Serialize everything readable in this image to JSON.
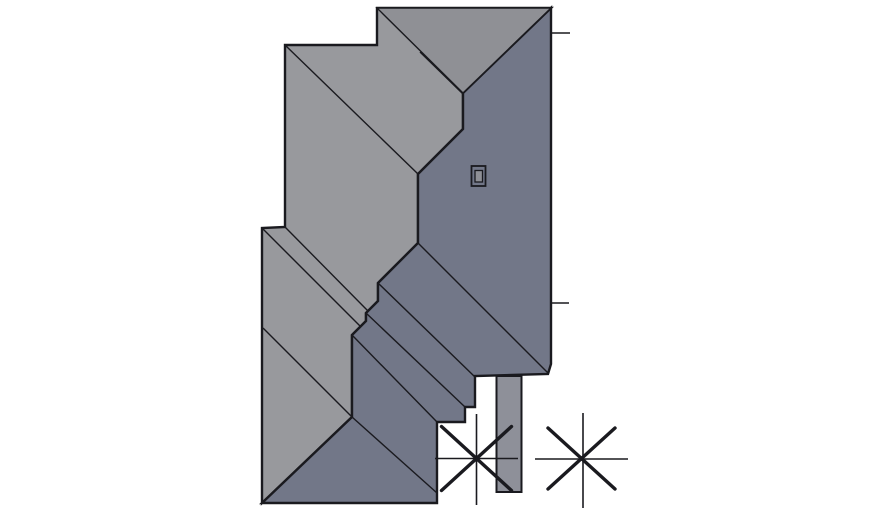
{
  "canvas": {
    "width": 870,
    "height": 515,
    "background": "#ffffff"
  },
  "colors": {
    "light_roof": "#98999d",
    "top_hip_face": "#8f9095",
    "dark_roof": "#727788",
    "strip_fill": "#8e9099",
    "vent_inner_fill": "#8f9096",
    "line": "#1a1a1f"
  },
  "roof_plan": {
    "light_region": {
      "points": [
        [
          377,
          8
        ],
        [
          551,
          8
        ],
        [
          463,
          93
        ],
        [
          463,
          129
        ],
        [
          418,
          174
        ],
        [
          418,
          243
        ],
        [
          378,
          283
        ],
        [
          378,
          301
        ],
        [
          366,
          313
        ],
        [
          366,
          321
        ],
        [
          352,
          335
        ],
        [
          352,
          417
        ],
        [
          262,
          503
        ],
        [
          262,
          228
        ],
        [
          285,
          227
        ],
        [
          285,
          45
        ],
        [
          377,
          45
        ]
      ]
    },
    "dark_region": {
      "points": [
        [
          551,
          8
        ],
        [
          551,
          364
        ],
        [
          548,
          374
        ],
        [
          475,
          376
        ],
        [
          475,
          407
        ],
        [
          465,
          407
        ],
        [
          465,
          422
        ],
        [
          437,
          422
        ],
        [
          437,
          503
        ],
        [
          262,
          503
        ],
        [
          352,
          417
        ],
        [
          352,
          335
        ],
        [
          366,
          321
        ],
        [
          366,
          313
        ],
        [
          378,
          301
        ],
        [
          378,
          283
        ],
        [
          418,
          243
        ],
        [
          418,
          174
        ],
        [
          463,
          129
        ],
        [
          463,
          93
        ]
      ]
    },
    "top_hip_face": {
      "points": [
        [
          377,
          8
        ],
        [
          551,
          8
        ],
        [
          463,
          93
        ]
      ]
    },
    "light_ridge_lines": [
      [
        [
          420,
          52
        ],
        [
          463,
          94
        ]
      ],
      [
        [
          285,
          45
        ],
        [
          418,
          174
        ]
      ],
      [
        [
          285,
          227
        ],
        [
          368,
          311
        ]
      ],
      [
        [
          262,
          228
        ],
        [
          360,
          326
        ]
      ],
      [
        [
          263,
          328
        ],
        [
          352,
          417
        ]
      ]
    ],
    "dark_ridge_lines": [
      [
        [
          418,
          243
        ],
        [
          548,
          373
        ]
      ],
      [
        [
          378,
          283
        ],
        [
          475,
          377
        ]
      ],
      [
        [
          366,
          313
        ],
        [
          465,
          407
        ]
      ],
      [
        [
          352,
          335
        ],
        [
          437,
          422
        ]
      ],
      [
        [
          352,
          417
        ],
        [
          437,
          493
        ]
      ]
    ],
    "chimney_strip": {
      "x": 496.5,
      "y": 376,
      "width": 25,
      "height": 116
    },
    "vent": {
      "outer": {
        "x": 471.5,
        "y": 166,
        "width": 14,
        "height": 20
      },
      "inner": {
        "x": 475,
        "y": 170.5,
        "width": 7.5,
        "height": 11.5
      }
    },
    "dimension_ticks": [
      [
        [
          551,
          33
        ],
        [
          570,
          33
        ]
      ],
      [
        [
          551,
          303
        ],
        [
          569,
          303
        ]
      ]
    ],
    "tree_symbols": [
      {
        "thin_lines": [
          [
            [
              476.5,
              414
            ],
            [
              476.5,
              505
            ]
          ],
          [
            [
              435,
              458.5
            ],
            [
              518,
              458.5
            ]
          ]
        ],
        "thick_lines": [
          [
            [
              441.5,
              426.5
            ],
            [
              511.5,
              490.5
            ]
          ],
          [
            [
              441.5,
              490.5
            ],
            [
              511.5,
              426.5
            ]
          ]
        ]
      },
      {
        "thin_lines": [
          [
            [
              583,
              413
            ],
            [
              583,
              508
            ]
          ],
          [
            [
              535,
              459
            ],
            [
              628,
              459
            ]
          ]
        ],
        "thick_lines": [
          [
            [
              548,
              428
            ],
            [
              615,
              489
            ]
          ],
          [
            [
              548,
              489
            ],
            [
              615,
              428
            ]
          ]
        ]
      }
    ]
  },
  "stroke_widths": {
    "outline": 2.4,
    "ridge": 1.4,
    "strip_border": 2,
    "vent_outer": 1.8,
    "vent_inner": 1.3,
    "tick": 1.4,
    "tree_thin": 1.6,
    "tree_thick": 3.4
  }
}
